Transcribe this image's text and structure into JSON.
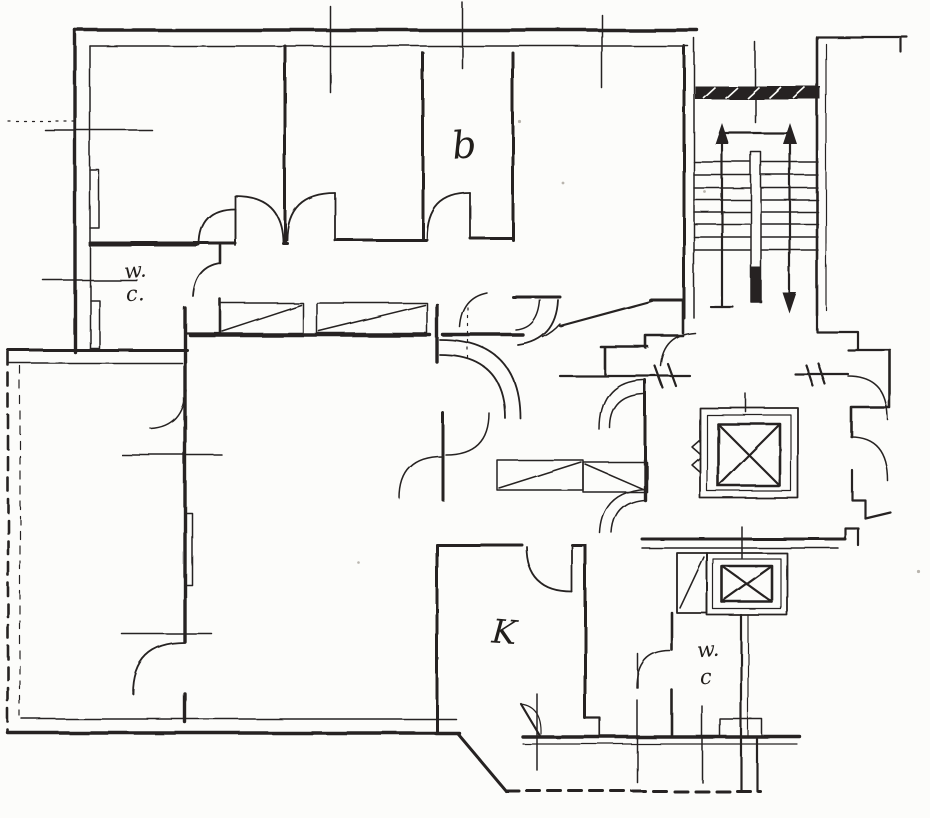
{
  "labels": {
    "bedroom": "b",
    "wc_upper": {
      "line1": "w.",
      "line2": "c."
    },
    "kitchen": "K",
    "wc_lower": {
      "line1": "w.",
      "line2": "c"
    }
  },
  "colors": {
    "ink": "#262320",
    "paper": "#fcfcfa"
  }
}
